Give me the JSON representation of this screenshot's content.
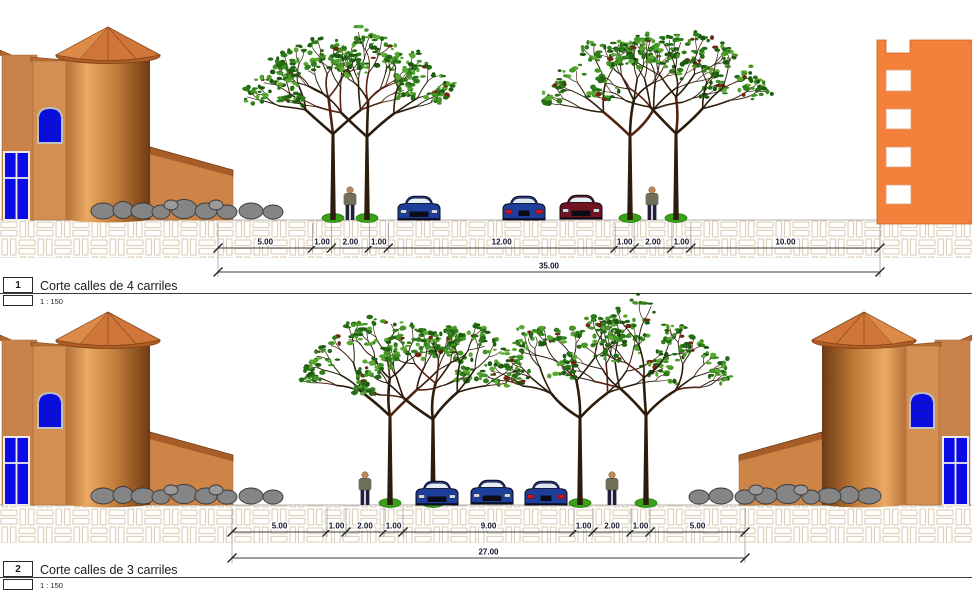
{
  "drawing": {
    "background": "#ffffff",
    "sections": [
      {
        "number": "1",
        "title": "Corte calles de 4 carriles",
        "scale": "1 : 150",
        "dimensions": [
          "5.00",
          "1.00",
          "2.00",
          "1.00",
          "12.00",
          "1.00",
          "2.00",
          "1.00",
          "10.00"
        ],
        "dimension_values": [
          5,
          1,
          2,
          1,
          12,
          1,
          2,
          1,
          10
        ],
        "total": "35.00"
      },
      {
        "number": "2",
        "title": "Corte calles de 3 carriles",
        "scale": "1 : 150",
        "dimensions": [
          "5.00",
          "1.00",
          "2.00",
          "1.00",
          "9.00",
          "1.00",
          "2.00",
          "1.00",
          "5.00"
        ],
        "dimension_values": [
          5,
          1,
          2,
          1,
          9,
          1,
          2,
          1,
          5
        ],
        "total": "27.00"
      }
    ],
    "colors": {
      "building_tan": "#d18a4d",
      "building_orange": "#f5803b",
      "window_blue": "#0a0ae6",
      "roof": "#c97034",
      "pavement_line": "#dbc9b2",
      "rock_gray": "#858585",
      "leaf_green": "#2f7d1a",
      "dim_text": "#14142a"
    }
  }
}
